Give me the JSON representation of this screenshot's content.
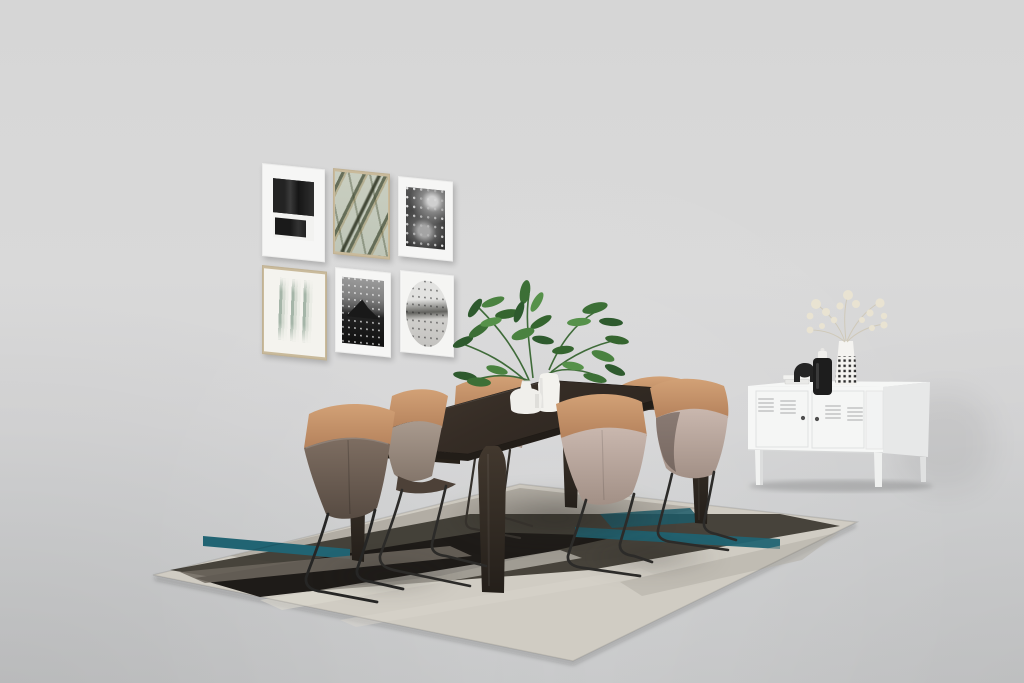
{
  "scene": {
    "description": "Photorealistic studio render of a dining room set on a seamless light gray backdrop",
    "wall_color": "#d8d8d8",
    "floor_color": "#cbcccd"
  },
  "palette": {
    "rug_cream": "#d0ccc3",
    "rug_charcoal": "#1e1b18",
    "rug_dark_band": "#3b3730",
    "rug_gray": "#a9a49b",
    "rug_warm_gray": "#6e675f",
    "rug_teal": "#216473",
    "chair_tan_light": "#d2a176",
    "chair_tan_dark": "#b5825c",
    "chair_blush_light": "#c9b7ae",
    "chair_blush_dark": "#a29086",
    "chair_dark_light": "#7e6e62",
    "chair_dark_dark": "#574b42",
    "wire_leg": "#2c2b29",
    "wood_light": "#473d33",
    "wood_dark": "#2d2620",
    "cabinet_white": "#f6f7f6",
    "plant_green": "#3c6f36"
  },
  "gallery": {
    "layout": "2 rows x 3 columns",
    "frames": [
      {
        "position": "top-left",
        "frame": "white",
        "mat": true,
        "art": "black textured abstract ink blocks"
      },
      {
        "position": "top-center",
        "frame": "gold",
        "mat": false,
        "art": "palm frond on sage green"
      },
      {
        "position": "top-right",
        "frame": "white",
        "mat": true,
        "art": "black and white portrait photograph"
      },
      {
        "position": "bottom-left",
        "frame": "gold",
        "mat": false,
        "art": "green watercolor streaks on white"
      },
      {
        "position": "bottom-center",
        "frame": "white",
        "mat": true,
        "art": "black and white mountain lake photograph"
      },
      {
        "position": "bottom-right",
        "frame": "white",
        "mat": false,
        "art": "monochrome oval landscape collage"
      }
    ]
  },
  "dining_set": {
    "table": {
      "material": "dark espresso wood",
      "shape": "rectangular",
      "legs": 4
    },
    "chairs": {
      "count": 6,
      "design": "two-tone shell chair on black wire sled base",
      "top_band": "tan leather",
      "bodies": [
        "dark taupe leather",
        "blush velvet"
      ]
    },
    "centerpiece": {
      "vases": [
        "white bottle vase",
        "white cylinder vase"
      ],
      "plant": "leafy green branches"
    }
  },
  "rug": {
    "style": "geometric diagonal color-block rug",
    "colors": [
      "cream",
      "charcoal",
      "warm gray",
      "teal"
    ]
  },
  "sideboard": {
    "type": "white metal locker cabinet",
    "doors": 2,
    "knobs": 2,
    "vent_groups": 4,
    "legs": 4,
    "decor": [
      "white book stack",
      "black elephant figurine",
      "black canister with white pump cap",
      "black-dotted vase with dried babys breath"
    ]
  }
}
